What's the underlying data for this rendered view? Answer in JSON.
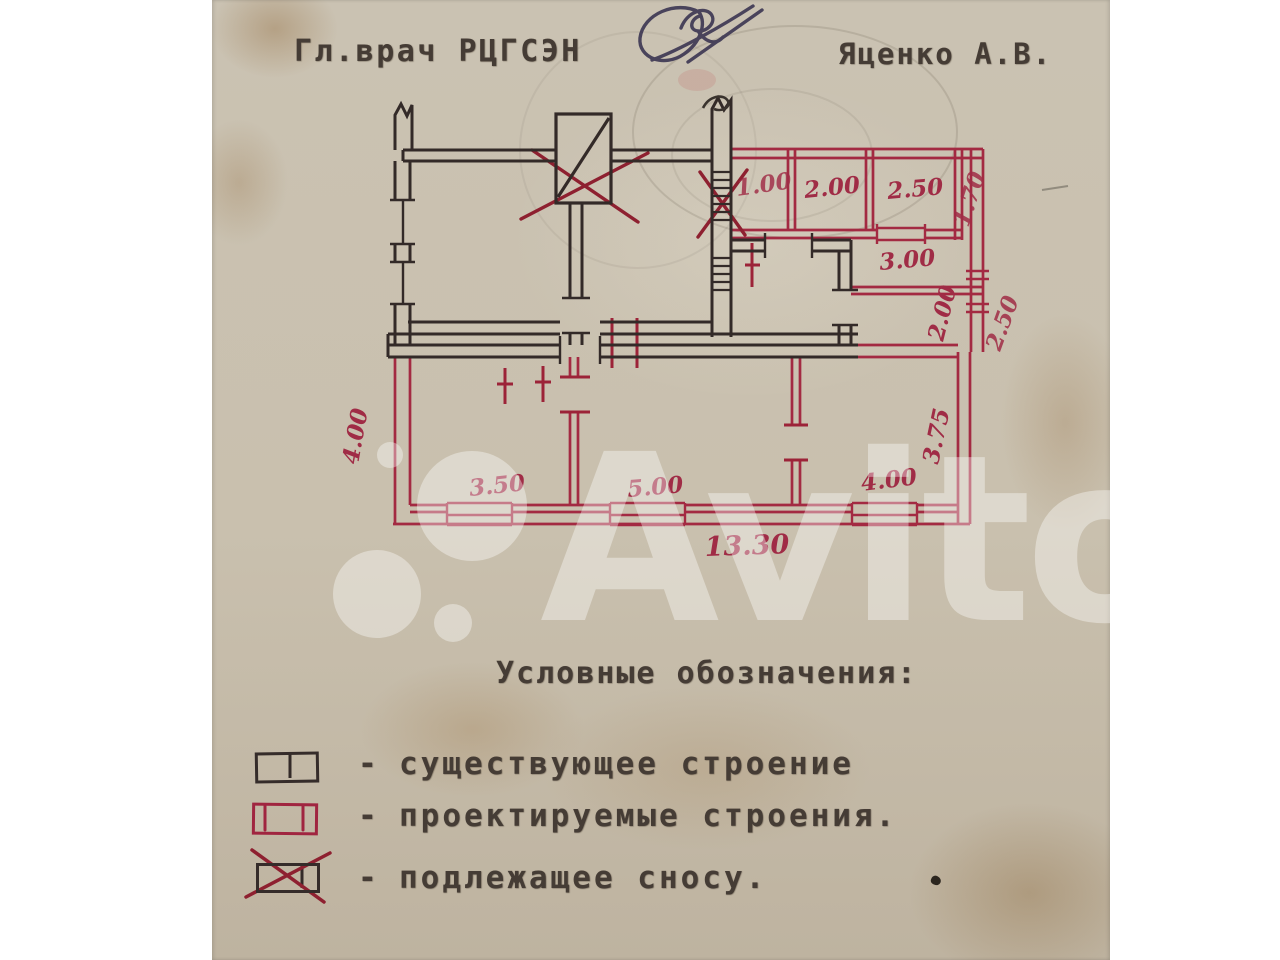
{
  "header": {
    "approver_title": "Гл.врач РЦГСЭН",
    "approver_name": "Яценко А.В.",
    "signature_icon": "handwritten-signature"
  },
  "watermark": {
    "text": "Avito",
    "logo_icon": "avito-circles-logo"
  },
  "plan": {
    "dimensions": {
      "top_room_1": "1.00",
      "top_room_2": "2.00",
      "top_room_3": "2.50",
      "right_strip": "1.70",
      "mid_room": "3.00",
      "right_mid": "2.00",
      "right_outer": "2.50",
      "right_lower": "3.75",
      "left_side": "4.00",
      "bottom_room_1": "3.50",
      "bottom_room_2": "5.00",
      "bottom_room_3": "4.00",
      "bottom_total": "13.30"
    }
  },
  "legend": {
    "title": "Условные обозначения:",
    "items": [
      {
        "dash": "-",
        "label": "существующее строение"
      },
      {
        "dash": "-",
        "label": "проектируемые строения."
      },
      {
        "dash": "-",
        "label": "подлежащее сносу."
      }
    ]
  },
  "colors": {
    "ink_black": "#332a28",
    "ink_red": "#a32a42",
    "signature_ink": "#3f3954",
    "paper": "#c9c1b0"
  }
}
